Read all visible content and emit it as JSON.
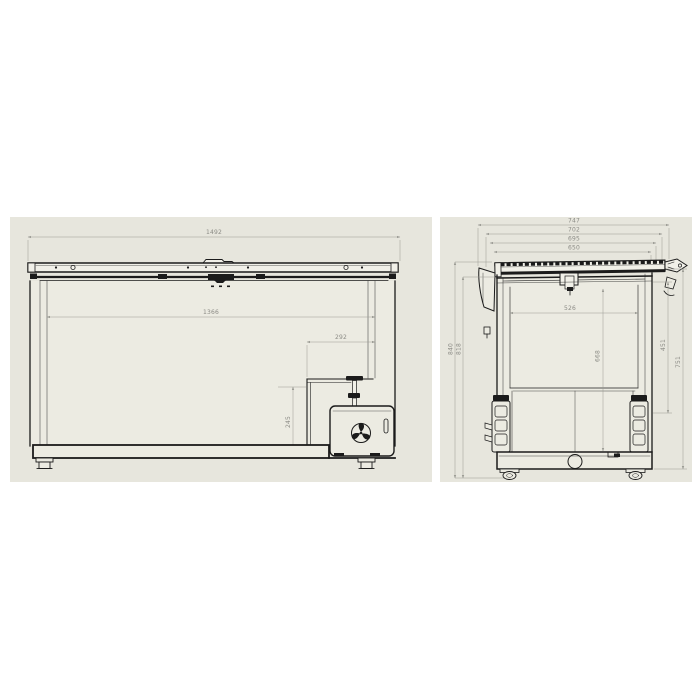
{
  "colors": {
    "page_bg": "#ffffff",
    "sheet_bg": "#e7e6dd",
    "line": "#1b1b1b",
    "dimension": "#8b8b85"
  },
  "front_view": {
    "dims": {
      "overall_width": "1492",
      "inner_width": "1366",
      "step_width": "292",
      "step_height": "245"
    }
  },
  "side_view": {
    "dims": {
      "overall_depth": "747",
      "lid_depth": "702",
      "top_depth": "695",
      "opening_depth": "650",
      "inner_depth": "526",
      "inner_height": "668",
      "upper_body_height": "451",
      "body_height": "751",
      "overall_height": "840",
      "height_to_lid": "818"
    }
  }
}
